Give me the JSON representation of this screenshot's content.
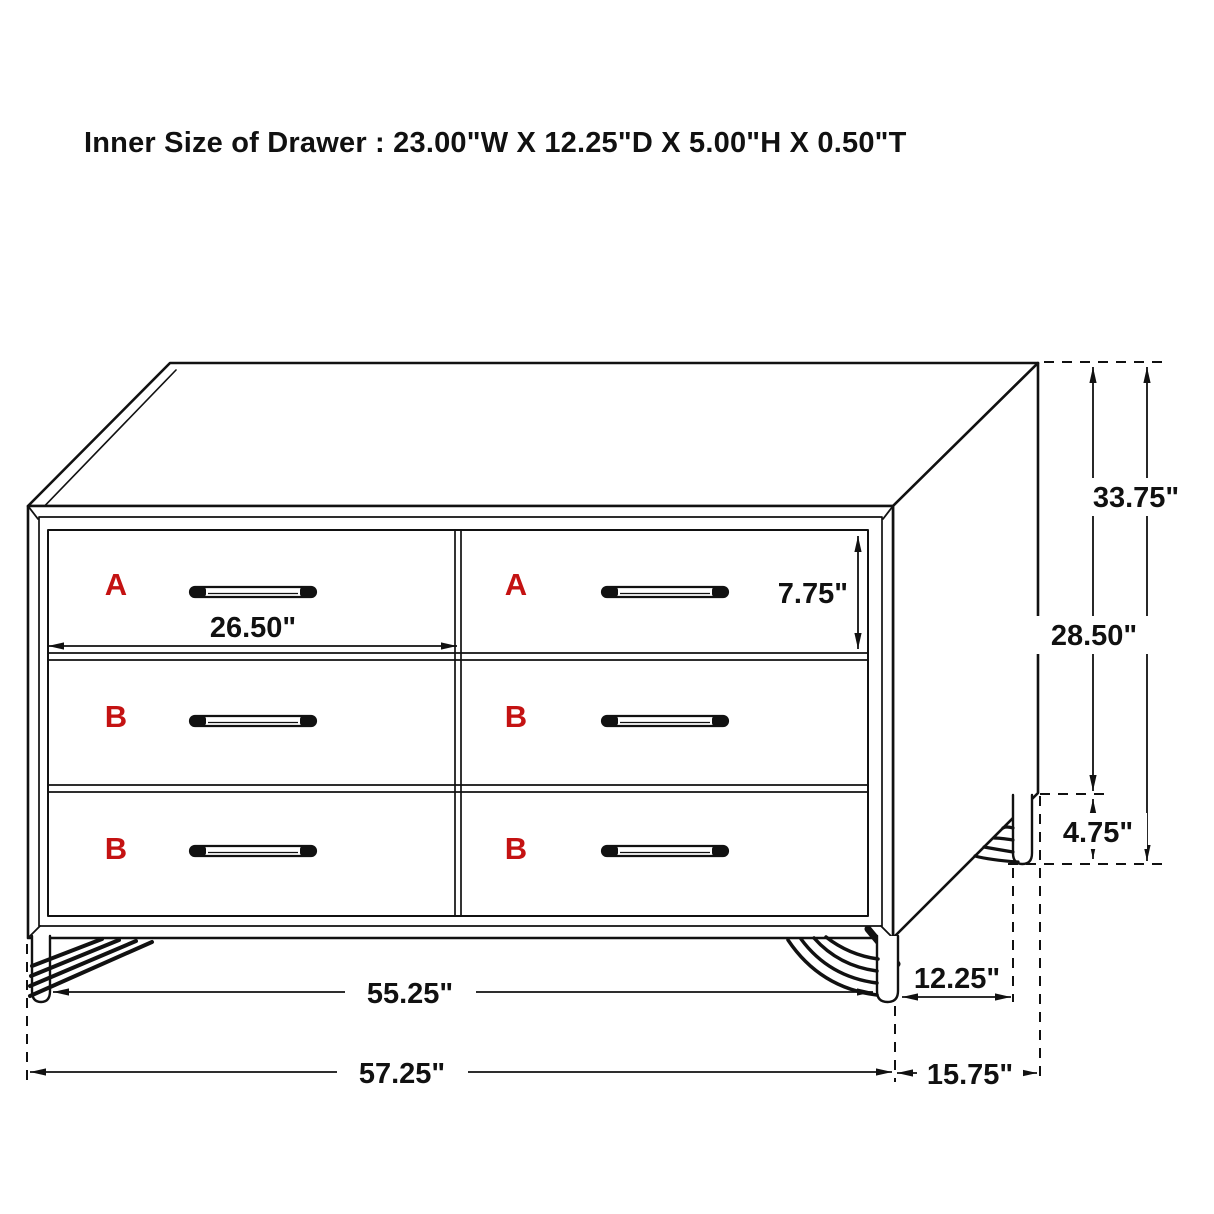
{
  "title": "Inner Size of Drawer : 23.00\"W X 12.25\"D X 5.00\"H X 0.50\"T",
  "drawers": {
    "row1": [
      "A",
      "A"
    ],
    "row2": [
      "B",
      "B"
    ],
    "row3": [
      "B",
      "B"
    ]
  },
  "dimensions": {
    "drawer_inner_width": "26.50\"",
    "drawer_face_height": "7.75\"",
    "overall_height": "33.75\"",
    "case_height": "28.50\"",
    "leg_height": "4.75\"",
    "front_leg_spacing": "55.25\"",
    "side_leg_spacing": "12.25\"",
    "overall_width": "57.25\"",
    "overall_depth": "15.75\""
  },
  "colors": {
    "line": "#111111",
    "label_red": "#c41212",
    "background": "#ffffff"
  }
}
